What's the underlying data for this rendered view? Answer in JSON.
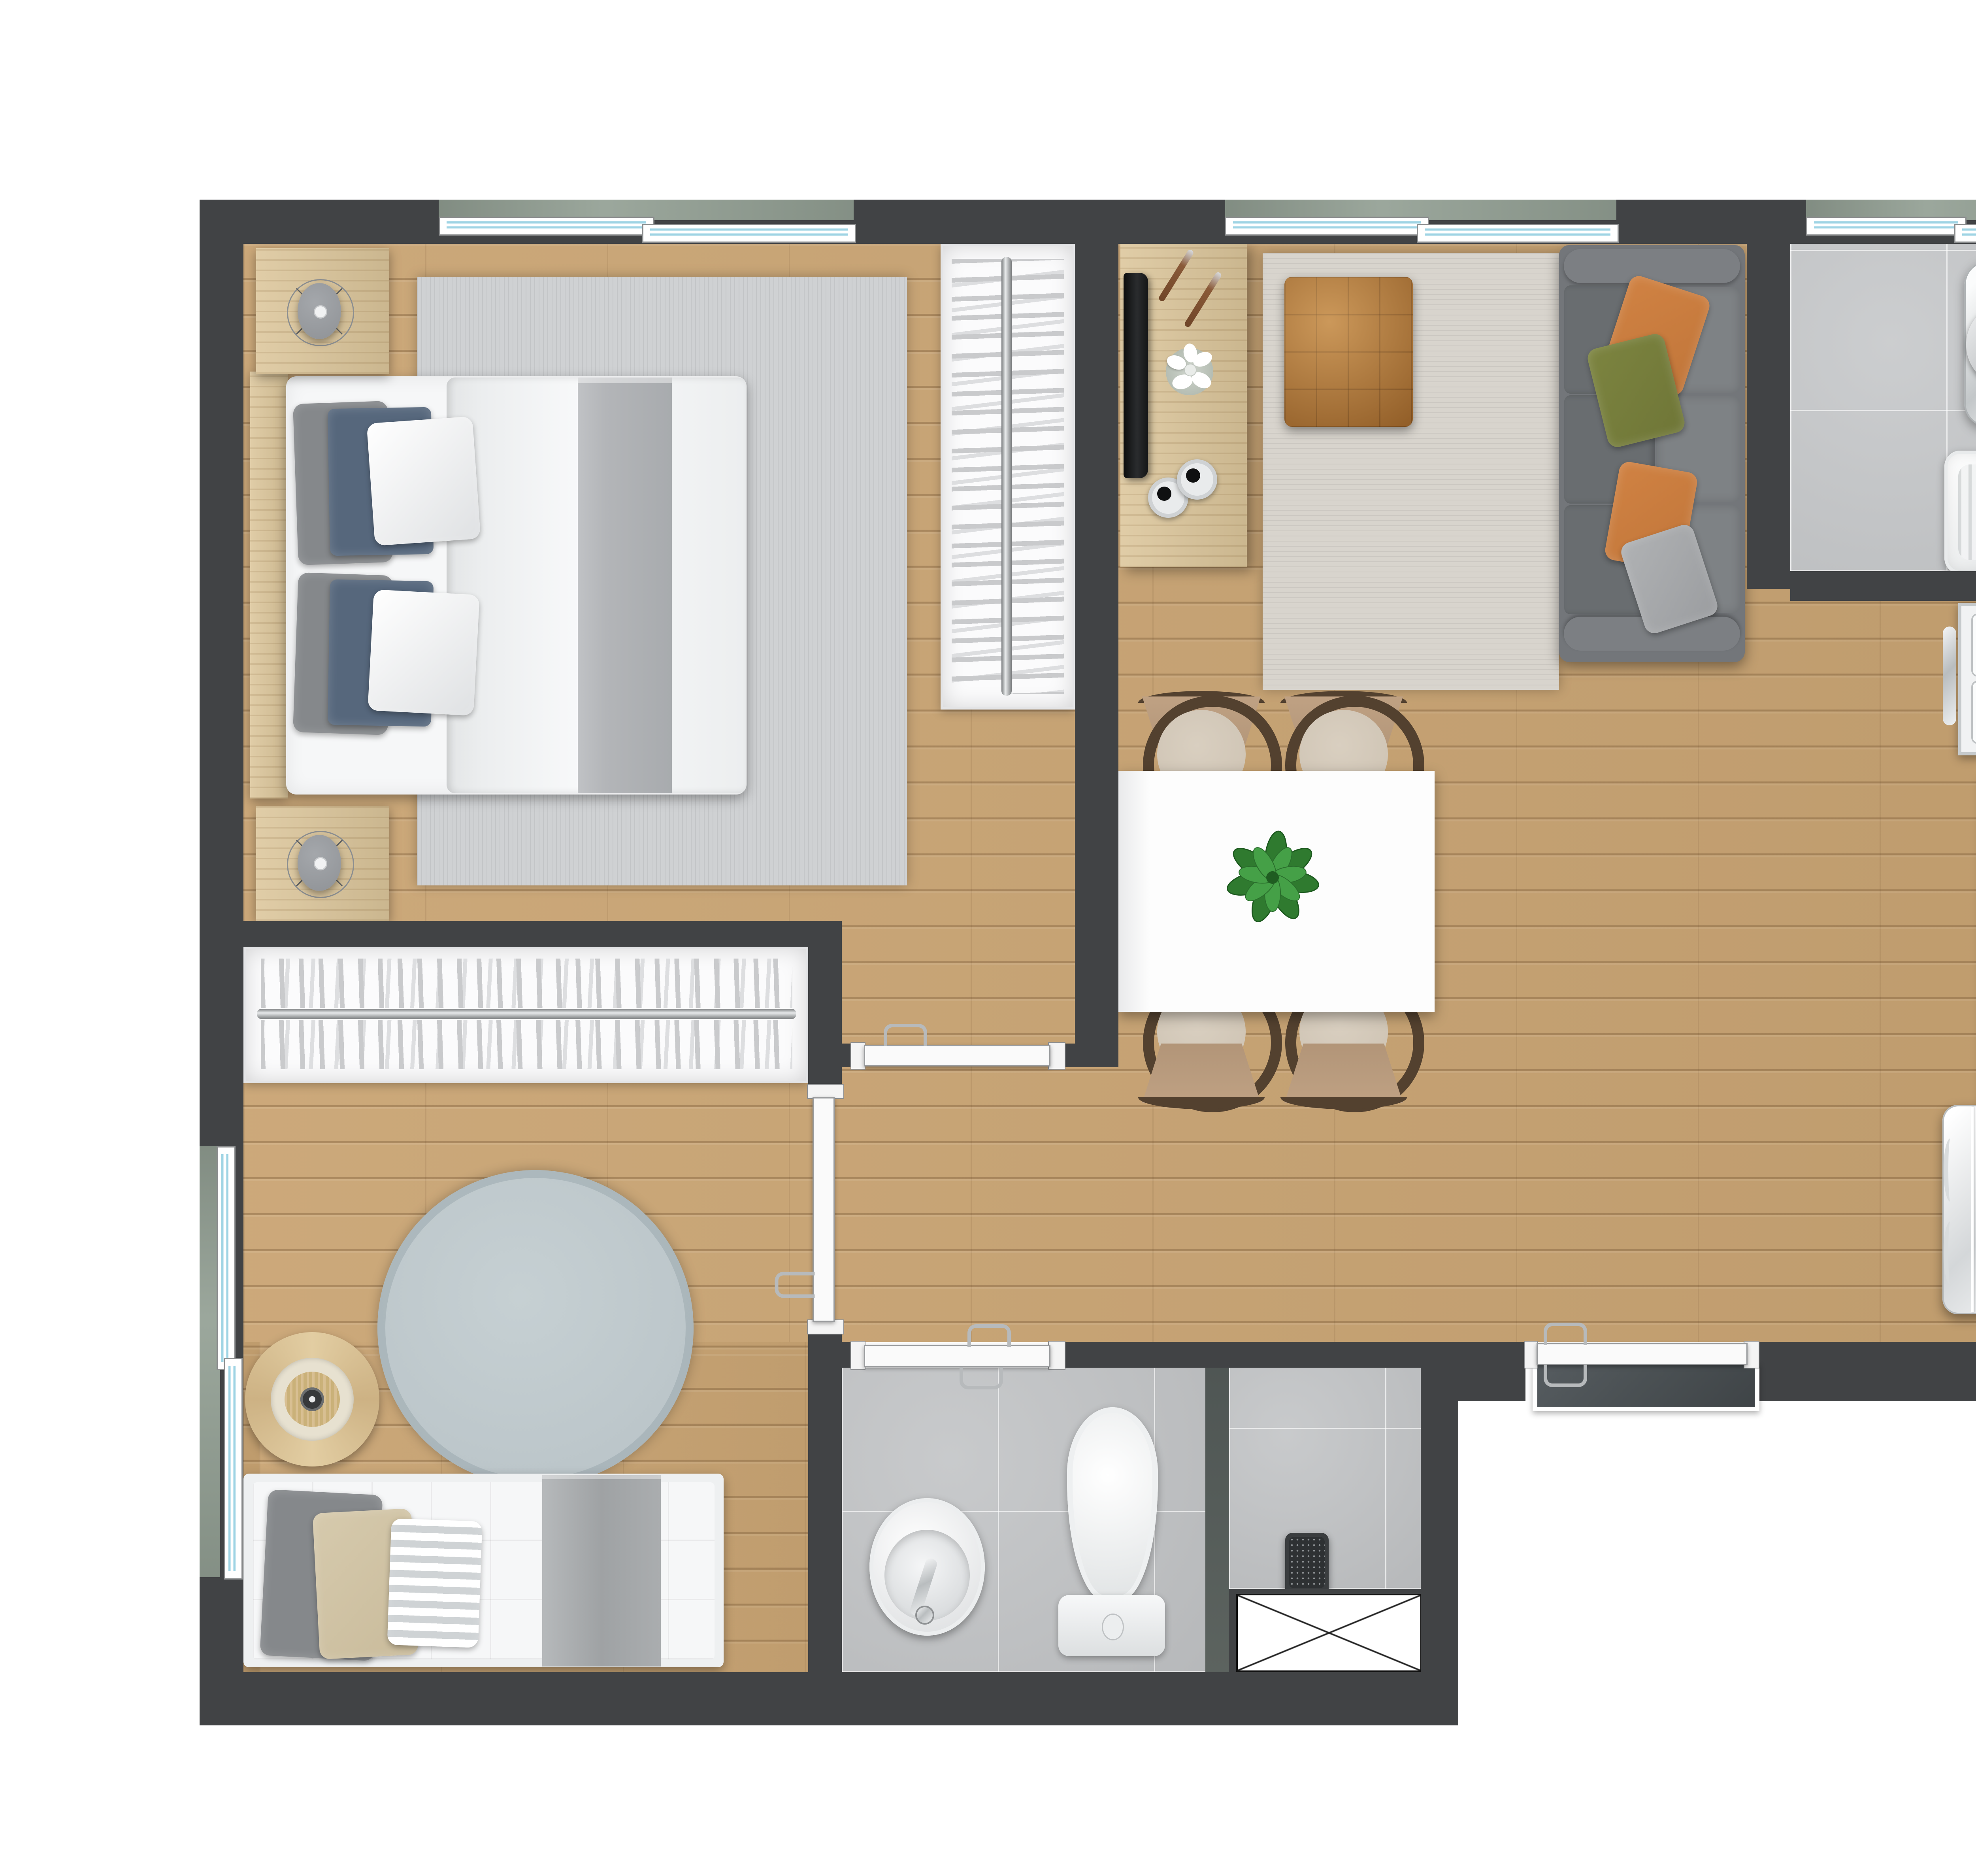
{
  "plan_title": "apartment-floor-plan-top-view",
  "palette": {
    "wall": "#414345",
    "white": "#ffffff",
    "wood": "#c9a473",
    "furnWood": "#dcc69b",
    "tile": "#c6c8ca",
    "tileBath": "#c2c4c6",
    "rugLiving": "#d8d4cd",
    "rugBedroom": "#cfd1d3",
    "rugRound": "#bcc6ca",
    "sillGreen": "#93A094",
    "glass": "#bfe7f2",
    "sofa": "#73767a",
    "sofaSeat": "#696d70",
    "sofaBack": "#7e8285",
    "pillowOrange": "#c1763a",
    "pillowOlive": "#6f7637",
    "pillowGrayLt": "#9b9da0",
    "pillowBlue": "#56677c",
    "pillowGrayDk": "#85888b",
    "pillowKhaki": "#c9bb9b",
    "ottoman": "#b0712f",
    "chairFrame": "#53412f",
    "chairWood": "#b29578",
    "chairSeat": "#cdc2b2",
    "table": "#fdfdfd",
    "plant": "#2f7a2f",
    "linen": "#f6f7f8",
    "duvet": "#eceeef",
    "blanket": "#b3b5b8",
    "slate": "#4b5154",
    "counter": "#b5b7b9",
    "chromeLight": "#e8eaeb",
    "applianceLight": "#f1f2f3"
  },
  "rooms": {
    "bedroom_main": {
      "name": "main bedroom",
      "furniture": [
        "double-bed",
        "blue-pillows",
        "nightstand-with-lamp",
        "nightstand-with-lamp",
        "area-rug",
        "wardrobe-with-hangers"
      ]
    },
    "bedroom_second": {
      "name": "second bedroom",
      "furniture": [
        "single-bed",
        "round-rug",
        "round-side-table",
        "closet-with-hangers"
      ]
    },
    "living_dining": {
      "name": "living and dining room",
      "furniture": [
        "three-seat-sofa",
        "orange-pillows",
        "olive-pillow",
        "leather-ottoman",
        "tv-console",
        "flat-tv",
        "flower-vase",
        "speakers",
        "dining-table",
        "dining-chairs-x4",
        "potted-plant",
        "area-rug"
      ]
    },
    "kitchen_laundry": {
      "name": "kitchen and laundry",
      "furniture": [
        "washing-machine",
        "laundry-tank-sink",
        "gas-cooktop",
        "counter-with-sink",
        "refrigerator",
        "service-shaft"
      ]
    },
    "bathroom": {
      "name": "bathroom",
      "furniture": [
        "pedestal-sink",
        "toilet",
        "shower-column",
        "service-shaft"
      ]
    }
  },
  "openings": {
    "windows": [
      "bedroom-top-window",
      "living-top-window",
      "kitchen-top-window",
      "bedroom2-left-window"
    ],
    "doors": [
      "bedroom-main-door",
      "bedroom-second-door",
      "bathroom-door",
      "entry-door-with-landing"
    ]
  }
}
